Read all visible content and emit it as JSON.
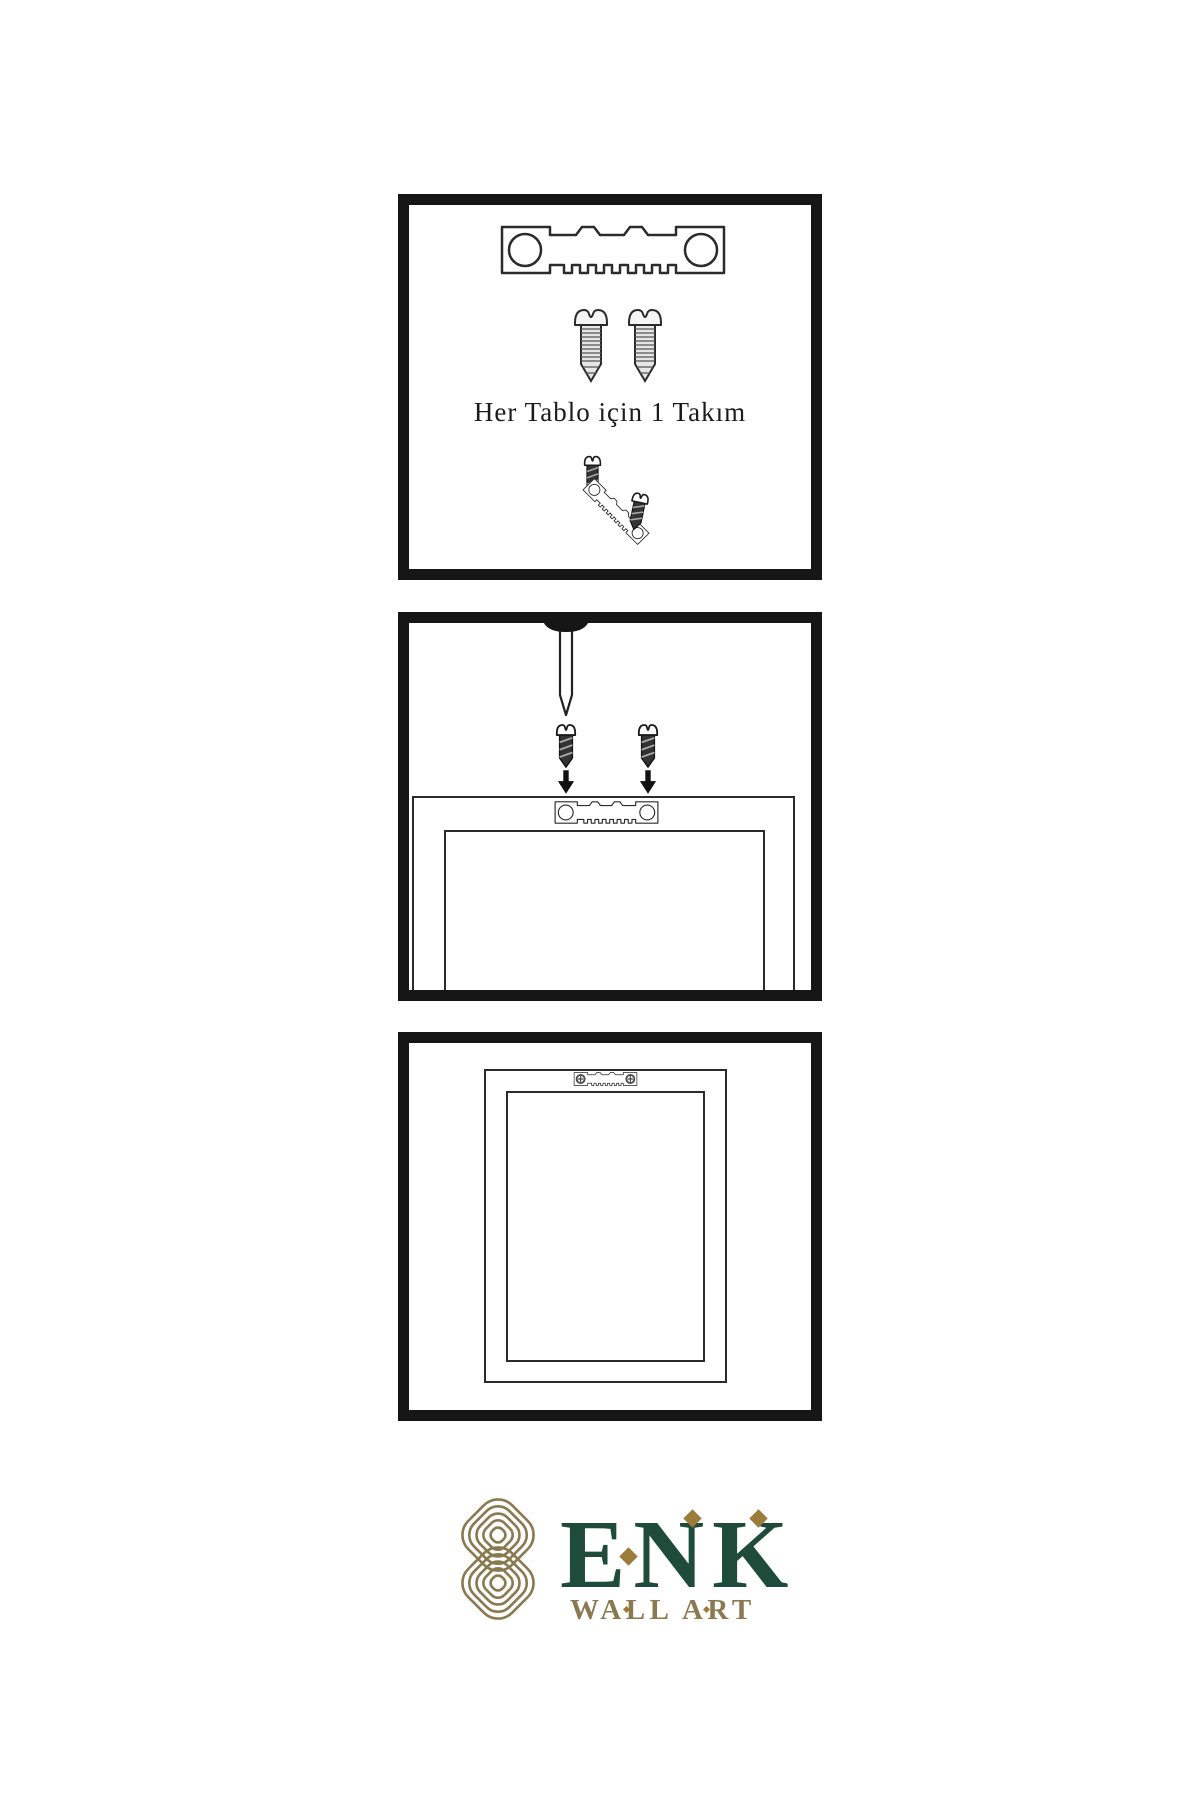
{
  "document": {
    "type": "wall-art hanging instructions infographic",
    "background": "#ffffff"
  },
  "panel1": {
    "caption": "Her Tablo için 1 Takım",
    "items": [
      "sawtooth-hanger",
      "screw",
      "screw",
      "screw-into-hanger-detail"
    ]
  },
  "panel2": {
    "items": [
      "nail-in-wall",
      "two-screws-with-down-arrows",
      "frame-back-with-sawtooth-hanger"
    ]
  },
  "panel3": {
    "items": [
      "hung-framed-picture-with-sawtooth-hanger"
    ]
  },
  "brand": {
    "name": "ENK",
    "tagline": "WALL ART"
  },
  "colors": {
    "panel_border": "#161616",
    "line_art": "#2b2b2b",
    "brand_green": "#1f4c3a",
    "brand_gold": "#8a7950",
    "accent_gold": "#9c7c3a"
  }
}
